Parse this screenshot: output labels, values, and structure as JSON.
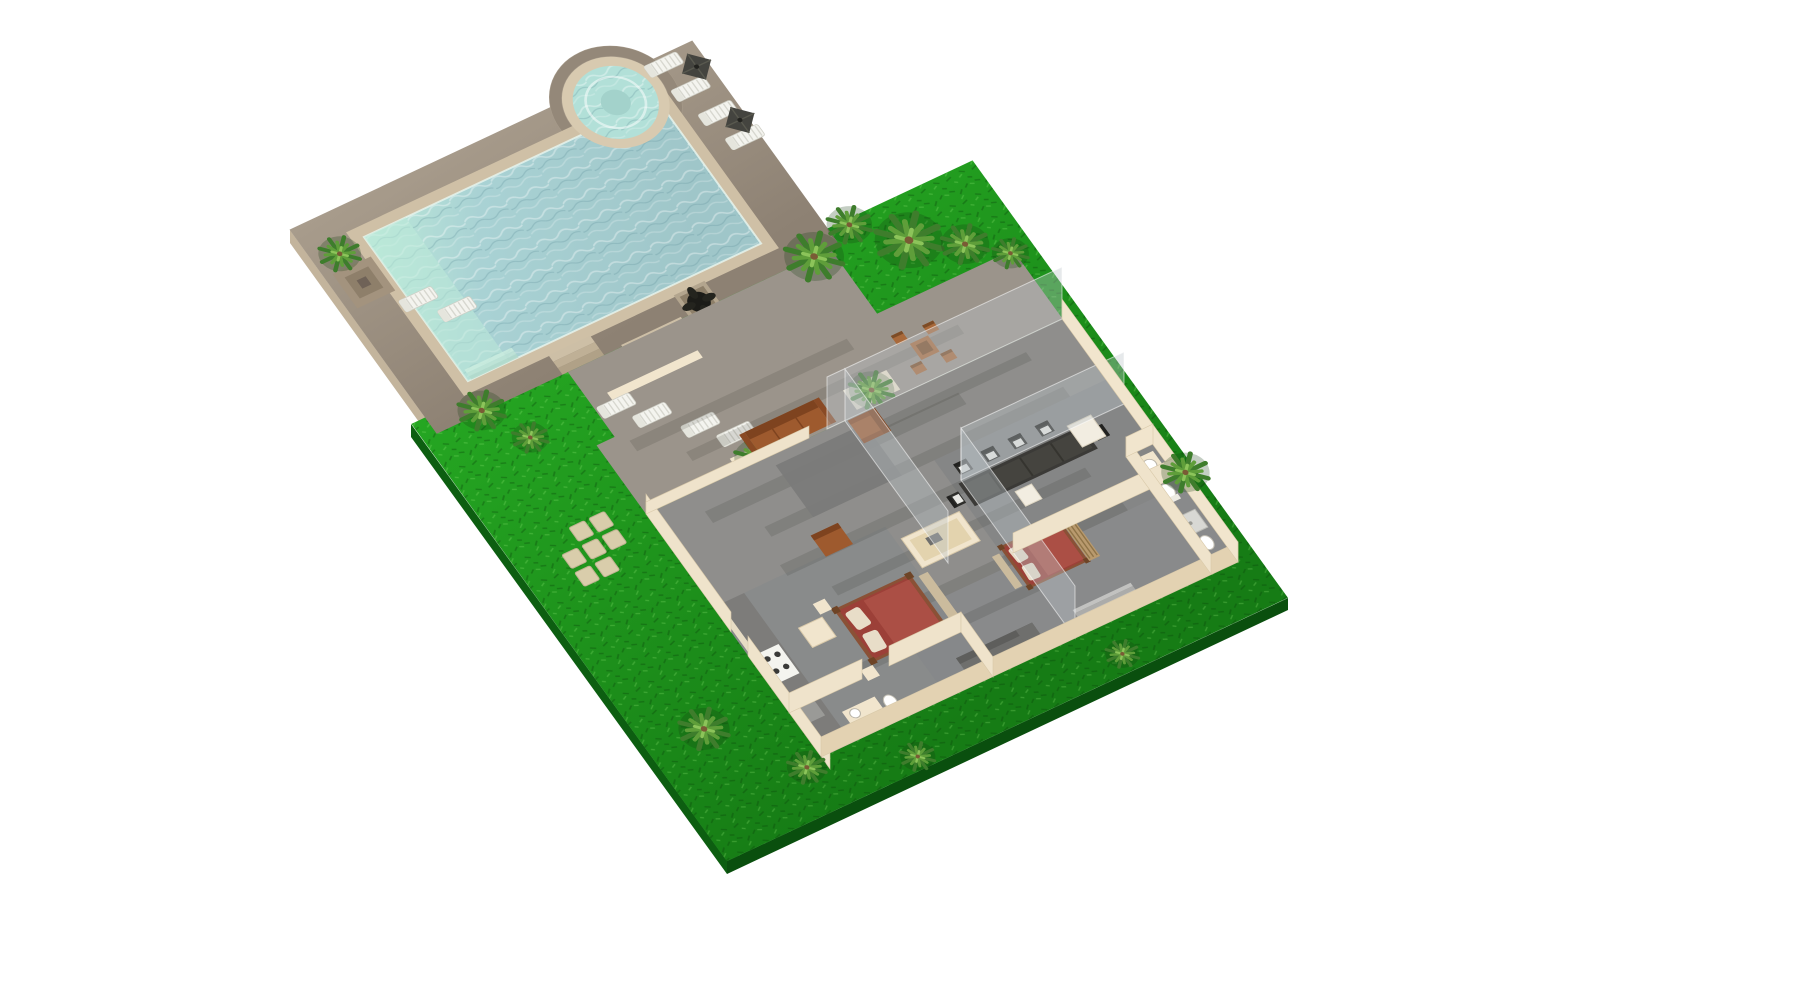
{
  "scene": {
    "title": "Isometric 3D villa floor plan with swimming pool, spa, terrace and tropical garden",
    "view": "isometric top-down render",
    "background": "#ffffff"
  },
  "palette": {
    "bg": "#ffffff",
    "deckLight": "#a89c8c",
    "deckDark": "#8d8173",
    "deckSide": "#c3b49c",
    "coping": "#cfc0a6",
    "copingLight": "#e2d5ba",
    "poolDeep": "#a9d2d4",
    "poolShallow": "#bcead celad",
    "poolShallow2": "#bce9d9",
    "spaWater": "#b2e0d8",
    "spaRim": "#d8cab0",
    "grass1": "#25a622",
    "grass2": "#167c15",
    "grassSide": "#0d5e11",
    "wallTop": "#f1e5cd",
    "wallSideLight": "#efe3cb",
    "wallSideDark": "#e3d2b2",
    "floorGray": "#8f8e8c",
    "floorDarkGray": "#7d7f82",
    "terraceFloor": "#9b948b",
    "rugGray": "#7b7b79",
    "sofaBrown": "#9e5a2e",
    "sofaBrownDark": "#7e431f",
    "sofaBrownArm": "#8a4a24",
    "bedRed": "#9c4038",
    "bedRedLight": "#ab4f45",
    "bedFrame": "#8a5136",
    "postBrown": "#6e4426",
    "benchTan": "#cbbb9d",
    "tableDark": "#3b3a37",
    "chairDark": "#2e2e2b",
    "seatPad": "#e8e8e4",
    "bistroBrown": "#a9693a",
    "bistroBrownDark": "#7d4c26",
    "stoneTan": "#d9cdab",
    "stairGray": "#c2c2c0",
    "stairGrayDark": "#acacaa",
    "sofaGray": "#6f6f6d",
    "sofaGrayDark": "#5e5e5c",
    "palmDark": "#3e7d2c",
    "palmMid": "#5f9e3a",
    "palmLight": "#8cc45a",
    "trunkBrown": "#7a5b35",
    "umbrellaDark": "#44443f",
    "plantBlack": "#1c1c18",
    "planterTan": "#b3a58e",
    "white": "#f4f4ef",
    "applianceWhite": "#f2ede1",
    "counterGray": "#7d7c7a",
    "glass": "rgba(190,198,202,0.38)",
    "shadow": "rgba(45,40,35,0.14)"
  },
  "inventory": {
    "pool_deck": {
      "label": "Pool deck",
      "items": [
        "swimming-pool",
        "spa-jacuzzi",
        "sun-loungers-x4",
        "parasols-x2",
        "pergola",
        "corner-loungers-x2",
        "palm-tree",
        "main-steps",
        "side-steps",
        "dark-planters-x2"
      ]
    },
    "terrace": {
      "label": "Lower terrace",
      "items": [
        "sun-loungers-x4",
        "banana-planters-x2",
        "brown-sofa",
        "armchairs-x2",
        "gray-rug",
        "low-cream-wall"
      ]
    },
    "garden": {
      "label": "Garden lawn",
      "items": [
        "palm-trees-x11",
        "stepping-stones-x7"
      ]
    },
    "house": {
      "label": "Open-top villa floor plan",
      "rooms": [
        {
          "name": "dining",
          "furniture": [
            "long-dark-table",
            "black-chairs-x6",
            "white-pedestal",
            "fridge"
          ]
        },
        {
          "name": "kitchen",
          "furniture": [
            "wall-counter",
            "stove-4-burner",
            "cream-island",
            "cabinet"
          ]
        },
        {
          "name": "master-bedroom",
          "furniture": [
            "four-poster-bed",
            "foot-bench",
            "nightstands-x2"
          ]
        },
        {
          "name": "bedroom-2",
          "furniture": [
            "four-poster-bed",
            "slat-headboard",
            "foot-bench"
          ]
        },
        {
          "name": "tv-room",
          "furniture": [
            "gray-sofa",
            "staircase"
          ]
        },
        {
          "name": "bathroom-1",
          "furniture": [
            "vanity-sink",
            "toilet"
          ]
        },
        {
          "name": "bathroom-2",
          "furniture": [
            "shower-tray",
            "toilet",
            "sink"
          ]
        },
        {
          "name": "ensuite",
          "furniture": [
            "vanity-sink",
            "toilet"
          ]
        }
      ],
      "outdoor": [
        "bistro-table",
        "bistro-chairs-x4",
        "glass-walls"
      ]
    }
  }
}
